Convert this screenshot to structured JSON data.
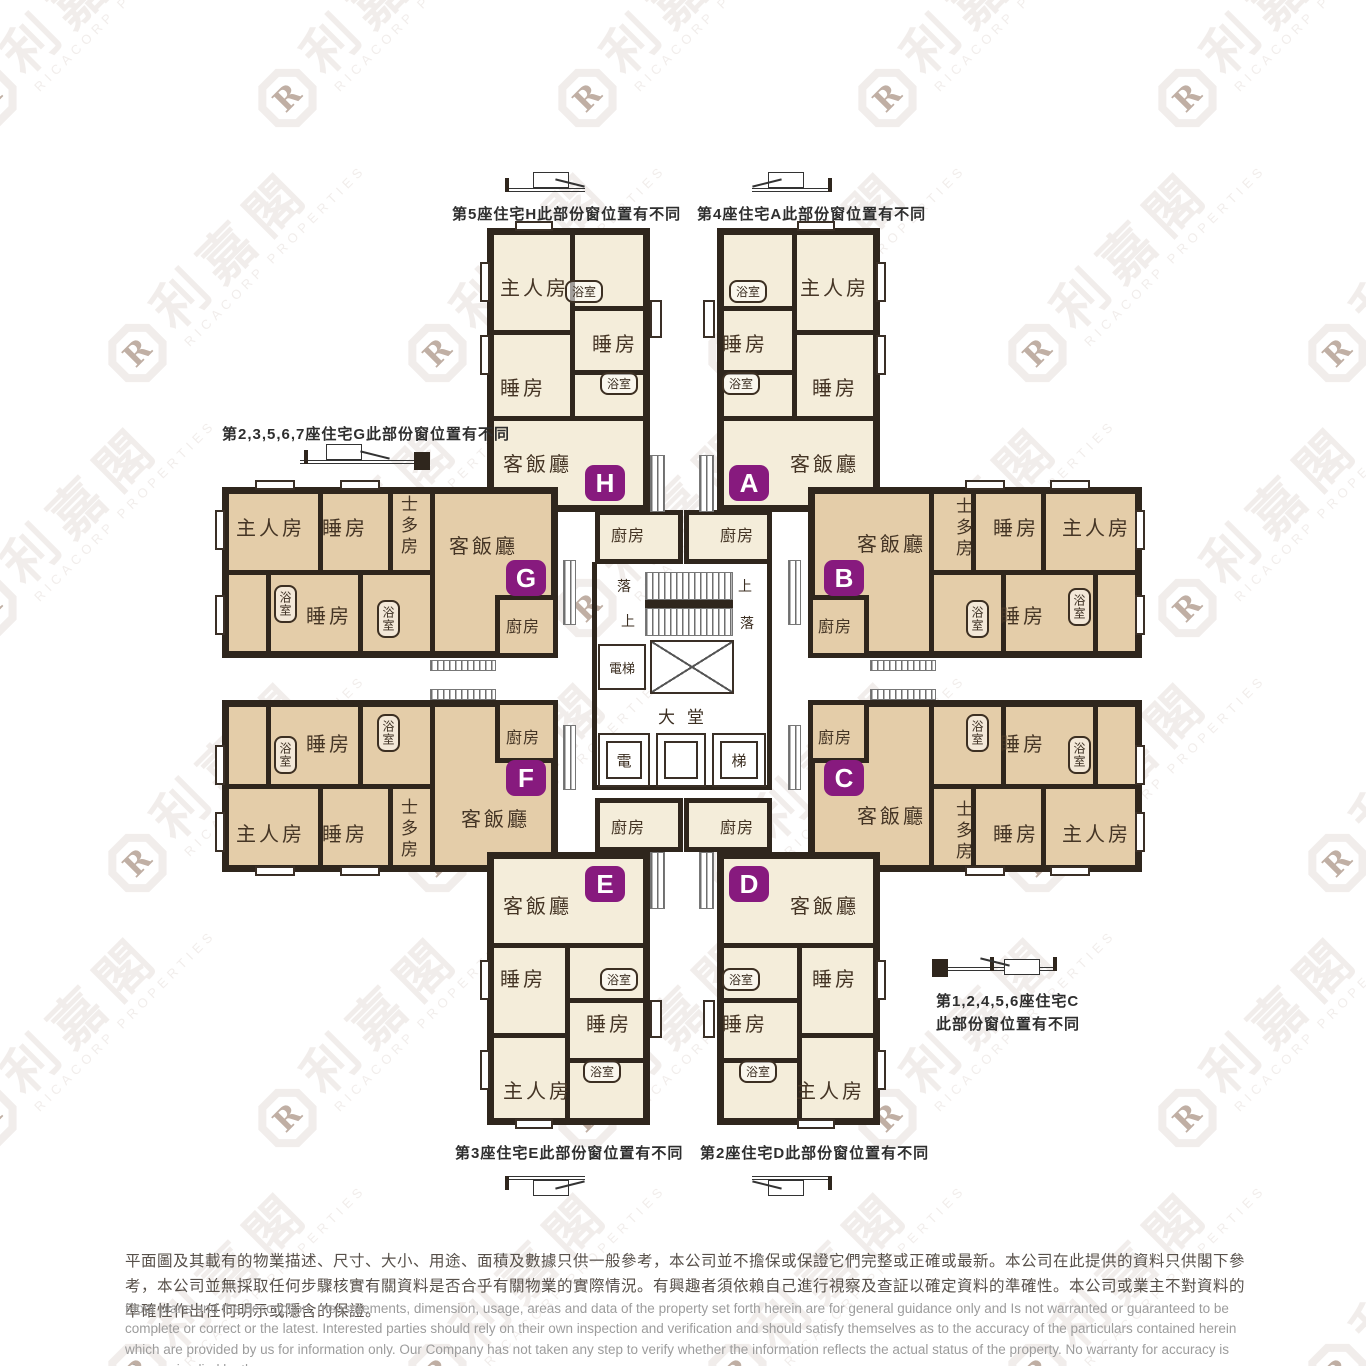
{
  "watermark": {
    "logo_letter": "R",
    "name_cn": "利嘉閣",
    "name_en": "RICACORP PROPERTIES"
  },
  "rooms": {
    "master_bedroom": "主人房",
    "bedroom": "睡房",
    "bathroom": "浴室",
    "living_dining": "客飯廳",
    "kitchen": "廚房",
    "storeroom": "士多房"
  },
  "core": {
    "lift": "電梯",
    "lobby": "大堂",
    "lift_left_char": "電",
    "lift_right_char": "梯",
    "up": "上",
    "down": "落"
  },
  "units": {
    "a": "A",
    "b": "B",
    "c": "C",
    "d": "D",
    "e": "E",
    "f": "F",
    "g": "G",
    "h": "H"
  },
  "annotations": {
    "unit_h": "第5座住宅H此部份窗位置有不同",
    "unit_a": "第4座住宅A此部份窗位置有不同",
    "unit_g": "第2,3,5,6,7座住宅G此部份窗位置有不同",
    "unit_e": "第3座住宅E此部份窗位置有不同",
    "unit_d": "第2座住宅D此部份窗位置有不同",
    "unit_c_line1": "第1,2,4,5,6座住宅C",
    "unit_c_line2": "此部份窗位置有不同"
  },
  "disclaimer": {
    "chinese": "平面圖及其載有的物業描述、尺寸、大小、用途、面積及數據只供一般參考，本公司並不擔保或保證它們完整或正確或最新。本公司在此提供的資料只供閣下參考，本公司並無採取任何步驟核實有關資料是否合乎有關物業的實際情況。有興趣者須依賴自己進行視察及查証以確定資料的準確性。本公司或業主不對資料的準確性作出任何明示或隱含的保證。",
    "english": "Floor plans and the description, measurements, dimension, usage, areas and data of the property set forth herein are for general guidance only and Is not warranted or guaranteed to be complete or correct or the latest. Interested parties should rely on their own inspection and verification and should satisfy themselves as to the accuracy of the particulars contained herein which are provided by us for information only.  Our Company has not taken any step to verify whether the information reflects the actual status of the property.  No warranty for accuracy is given or implied by the owners or us."
  },
  "colors": {
    "wall": "#2f261d",
    "floor_cream": "#f4edda",
    "floor_tan": "#e4cda9",
    "badge_purple": "#871a7e"
  }
}
